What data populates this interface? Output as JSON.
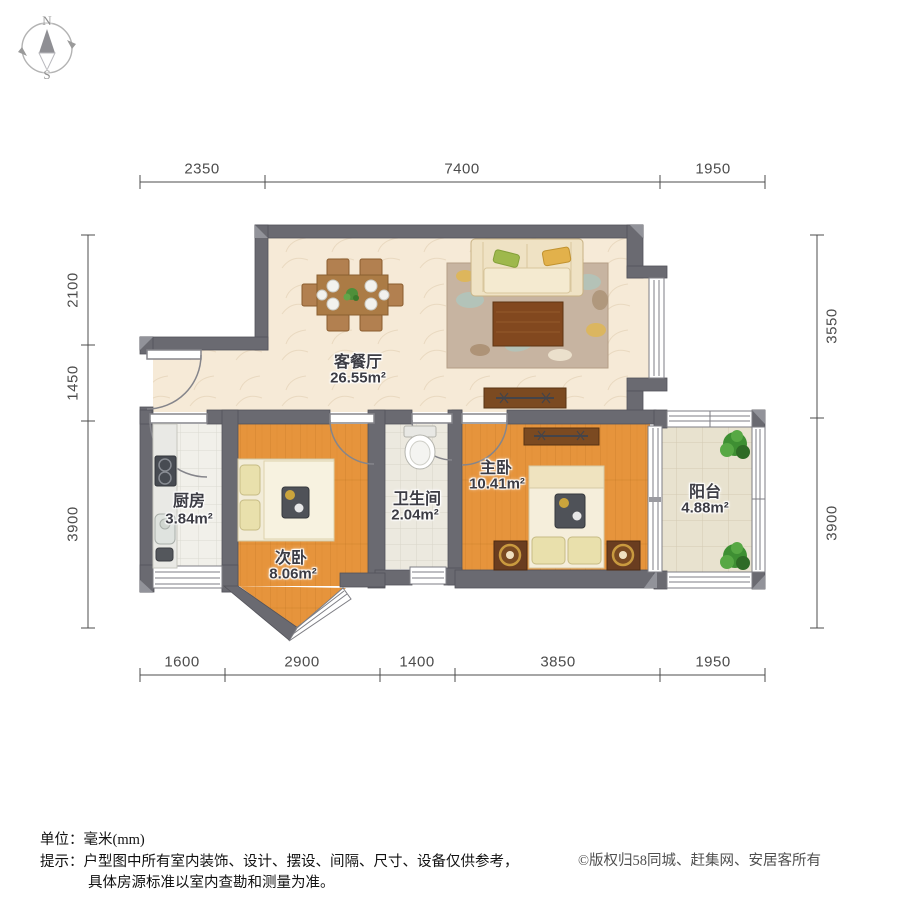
{
  "compass": {
    "north": "N",
    "south": "S"
  },
  "dimensions": {
    "unit": "mm",
    "top": [
      "2350",
      "7400",
      "1950"
    ],
    "bottom": [
      "1600",
      "2900",
      "1400",
      "3850",
      "1950"
    ],
    "left": [
      "2100",
      "1450",
      "3900"
    ],
    "right": [
      "3550",
      "3900"
    ]
  },
  "rooms": [
    {
      "id": "living-dining",
      "name": "客餐厅",
      "area": "26.55m²"
    },
    {
      "id": "kitchen",
      "name": "厨房",
      "area": "3.84m²"
    },
    {
      "id": "second-bedroom",
      "name": "次卧",
      "area": "8.06m²"
    },
    {
      "id": "bathroom",
      "name": "卫生间",
      "area": "2.04m²"
    },
    {
      "id": "master-bedroom",
      "name": "主卧",
      "area": "10.41m²"
    },
    {
      "id": "balcony",
      "name": "阳台",
      "area": "4.88m²"
    }
  ],
  "footer": {
    "unit_label": "单位：毫米(mm)",
    "tip_line1": "提示：户型图中所有室内装饰、设计、摆设、间隔、尺寸、设备仅供参考，",
    "tip_line2": "具体房源标准以室内查勘和测量为准。",
    "copyright": "©版权归58同城、赶集网、安居客所有"
  },
  "colors": {
    "wall": "#6a6a71",
    "wood_floor": "#e6943c",
    "living_floor": "#f6ead7",
    "kitchen_floor": "#f1f0ea",
    "balcony_floor": "#e8e2cf",
    "dimension_line": "#4c4c4c"
  }
}
